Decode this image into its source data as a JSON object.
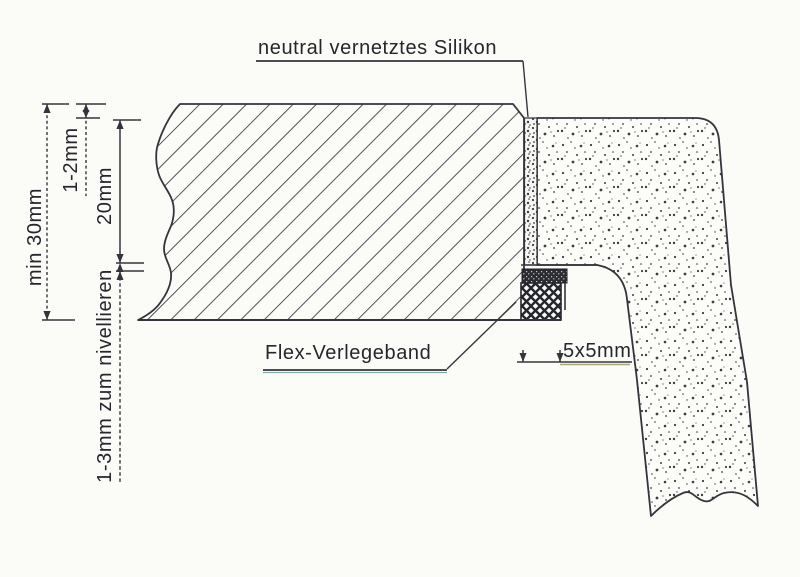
{
  "drawing": {
    "title_label": "neutral vernetztes Silikon",
    "labels": {
      "silicone": "neutral vernetztes Silikon",
      "flex_tape": "Flex-Verlegeband"
    },
    "dimensions": {
      "countertop_thickness": "min 30mm",
      "surface_offset": "1-2mm",
      "rebate_depth": "20mm",
      "leveling_gap": "1-3mm zum nivellieren",
      "tape_size": "5x5mm"
    },
    "colors": {
      "paper": "#fbfbf8",
      "line": "#34343c",
      "text": "#26262e",
      "underline_flex": "#4f8f8a",
      "underline_tape": "#8f8f4a"
    }
  }
}
